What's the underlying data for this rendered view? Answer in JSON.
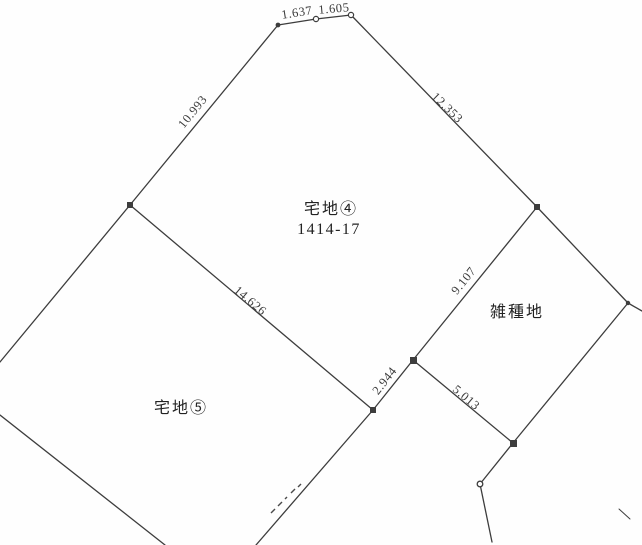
{
  "parcels": [
    {
      "label": "宅地④",
      "number": "1414-17"
    },
    {
      "label": "宅地⑤"
    },
    {
      "label": "雑種地"
    }
  ],
  "edges": [
    {
      "name": "top-segment-left",
      "length": "1.637"
    },
    {
      "name": "top-segment-right",
      "length": "1.605"
    },
    {
      "name": "northwest-boundary",
      "length": "10.993"
    },
    {
      "name": "northeast-boundary",
      "length": "12.353"
    },
    {
      "name": "parcel4-parcel5-boundary",
      "length": "14.626"
    },
    {
      "name": "parcel4-misc-boundary",
      "length": "9.107"
    },
    {
      "name": "junction-segment",
      "length": "2.944"
    },
    {
      "name": "misc-south-boundary",
      "length": "5.013"
    }
  ],
  "colors": {
    "line": "#3d3d3d",
    "text": "#2e2e2e",
    "background": "#fefefe"
  }
}
